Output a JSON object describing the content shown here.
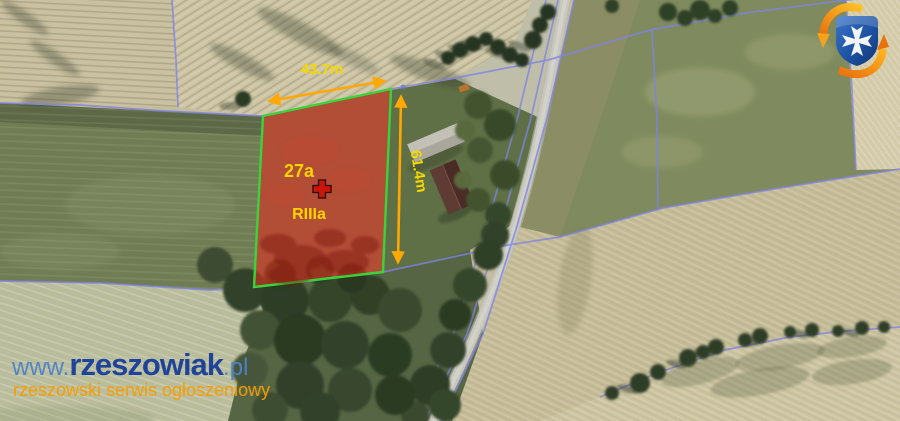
{
  "annotation": {
    "width_label": "43.7m",
    "height_label": "61.4m",
    "area_label": "27a",
    "soil_class_label": "RIIIa"
  },
  "watermark": {
    "prefix": "www.",
    "brand": "rzeszowiak",
    "suffix": ".pl",
    "tagline": "rzeszowski serwis ogłoszeniowy"
  },
  "icons": {
    "logo": "rzeszowiak-logo (blue shield with white maltese cross inside orange refresh arrows)",
    "marker": "cross-marker"
  },
  "colors": {
    "parcel_fill": "#ad3520",
    "parcel_border": "#3bd33c",
    "dimension_arrow": "#ffa800",
    "dimension_label": "#f5d800",
    "parcel_label": "#ffd400",
    "cadastral_line": "#7f82e6",
    "marker_cross": "#c8170a",
    "watermark_light": "#4d82c8",
    "watermark_dark": "#1a3f9a",
    "watermark_orange": "#f89c00",
    "logo_shield": "#1d4f9e",
    "logo_swirl": "#f07d12"
  }
}
